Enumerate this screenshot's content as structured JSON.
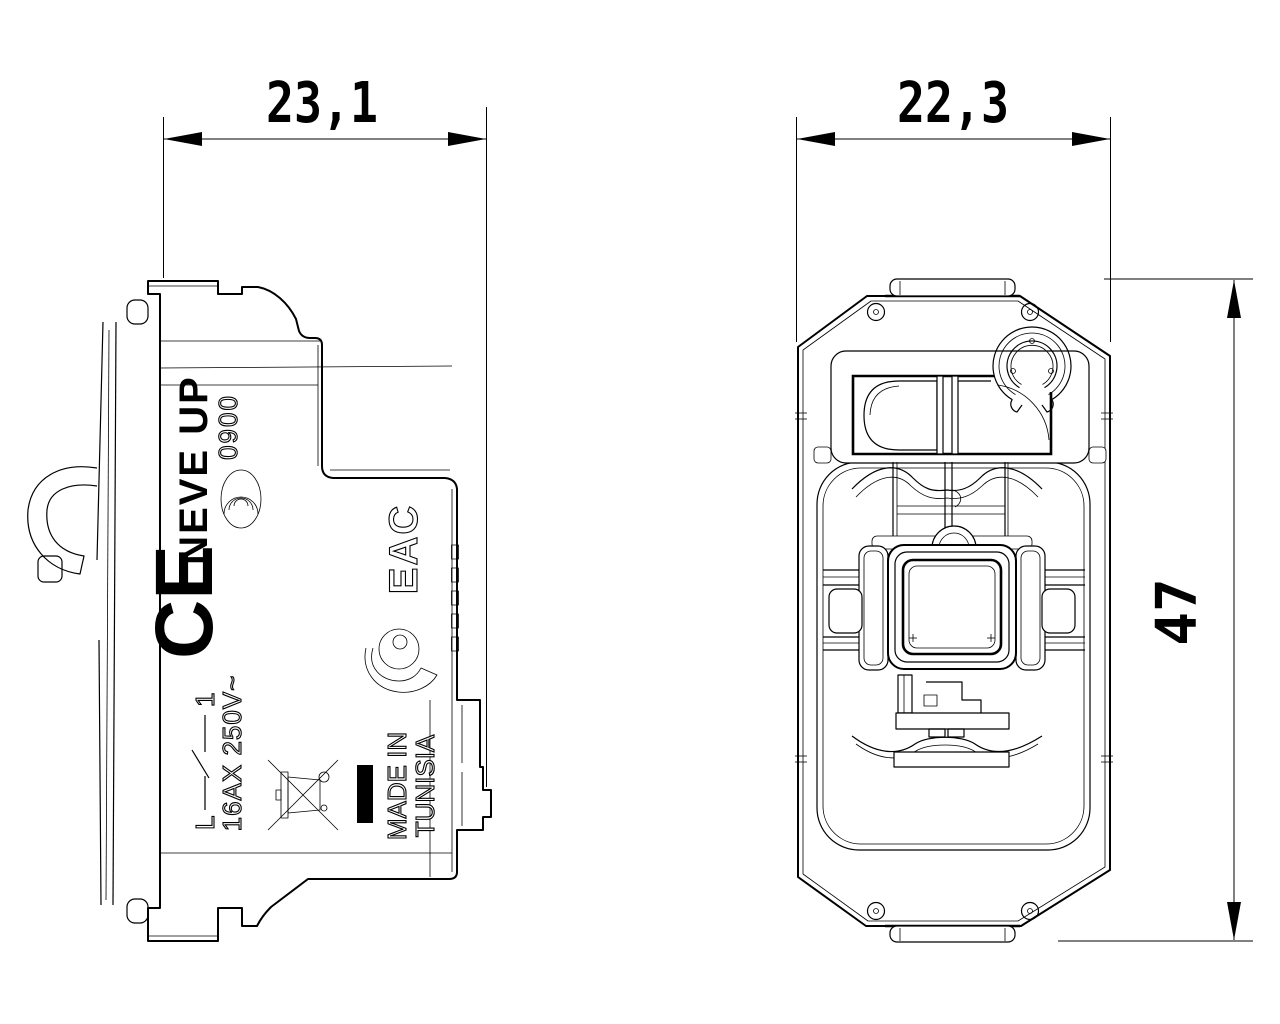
{
  "drawing": {
    "title": "switch module technical drawing, two views",
    "background_color": "#ffffff",
    "line_color": "#000000",
    "dimensions": [
      {
        "id": "side-view-width",
        "value": "23,1",
        "unit": "mm",
        "orientation": "horizontal"
      },
      {
        "id": "front-view-width",
        "value": "22,3",
        "unit": "mm",
        "orientation": "horizontal"
      },
      {
        "id": "front-view-height",
        "value": "47",
        "unit": "mm",
        "orientation": "vertical"
      }
    ],
    "labels": {
      "brand": "NEVE UP",
      "cert_number": "0900",
      "ce": "CE",
      "eac": "EAC",
      "switch_l": "L",
      "switch_1": "1",
      "rating": "16AX 250V~",
      "made_in_1": "MADE IN",
      "made_in_2": "TUNISIA"
    },
    "symbols": [
      "certification-arcs-icon",
      "imq-quality-mark-icon",
      "switch-contact-symbol",
      "weee-crossed-bin-icon",
      "black-conformity-bar"
    ]
  }
}
